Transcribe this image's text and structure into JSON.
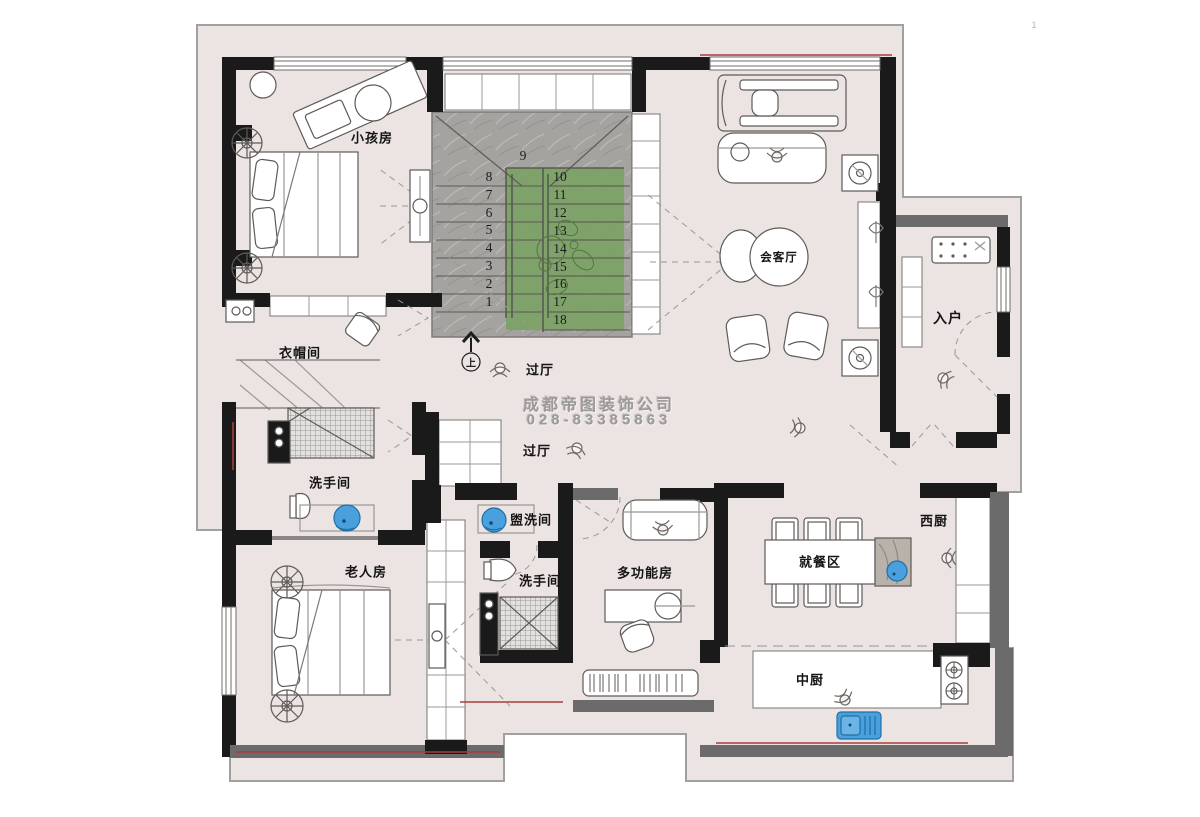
{
  "page": {
    "corner_mark": "1"
  },
  "watermark": {
    "company": "成都帝图装饰公司",
    "phone": "028-83385863"
  },
  "rooms": {
    "kids_room": "小孩房",
    "reception_room": "会客厅",
    "entry": "入户",
    "cloakroom": "衣帽间",
    "hall_upper": "过厅",
    "hall_lower": "过厅",
    "bathroom_left": "洗手间",
    "elder_room": "老人房",
    "washroom": "盥洗间",
    "bathroom_middle": "洗手间",
    "multifunction_room": "多功能房",
    "dining_area": "就餐区",
    "west_kitchen": "西厨",
    "chinese_kitchen": "中厨"
  },
  "stairs": {
    "up": "上",
    "steps": [
      "1",
      "2",
      "3",
      "4",
      "5",
      "6",
      "7",
      "8",
      "9",
      "10",
      "11",
      "12",
      "13",
      "14",
      "15",
      "16",
      "17",
      "18"
    ]
  },
  "colors": {
    "floor": "#ece3e3",
    "wall_black": "#1a1a1a",
    "wall_gray": "#6b6b6b",
    "stair_marble": "#a5a3a0",
    "stair_carpet": "#7ca266",
    "fixture_blue": "#4aa0dc",
    "accent_red": "#a5403c"
  }
}
